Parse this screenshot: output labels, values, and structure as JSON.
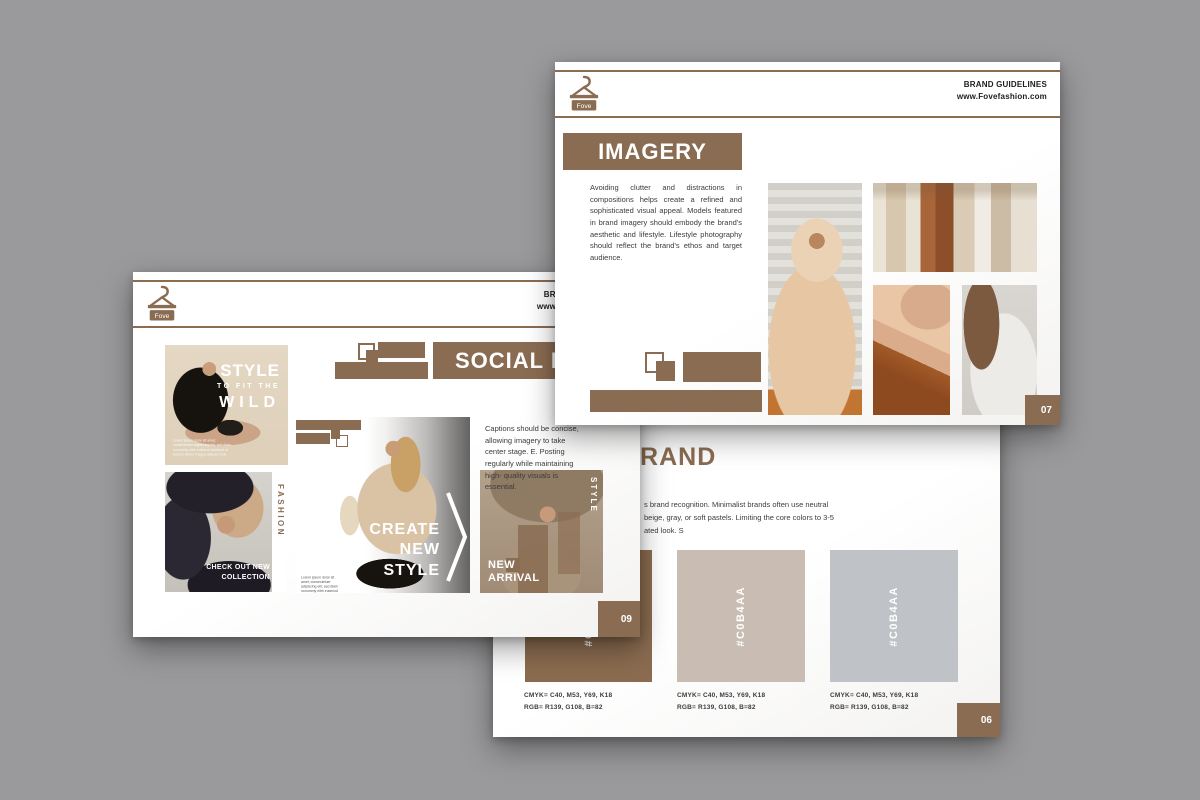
{
  "background": "#9a9a9c",
  "theme": {
    "brown": "#8a6c52",
    "text_dark": "#3c3c3c"
  },
  "logo": {
    "name": "Fove"
  },
  "header": {
    "line1": "BRAND GUIDELINES",
    "line2": "www.Fovefashion.com"
  },
  "pages": {
    "imagery": {
      "title": "IMAGERY",
      "body": "Avoiding clutter and distractions in compositions helps create a refined and sophisticated visual appeal. Models featured in brand imagery should embody the brand's aesthetic and lifestyle. Lifestyle photography should reflect the brand's ethos and target audience.",
      "page_number": "07"
    },
    "social": {
      "title": "SOCIAL MEDIA",
      "caption": "Captions should be concise, allowing imagery to take center stage. E. Posting regularly while maintaining high- quality visuals is essential.",
      "page_number": "09",
      "posts": {
        "wild": {
          "line1": "STYLE",
          "line2": "TO FIT THE",
          "line3": "WILD"
        },
        "fashion": {
          "vertical": "FASHION",
          "cta1": "CHECK OUT NEW",
          "cta2": "COLLECTION"
        },
        "create": {
          "line1": "CREATE",
          "line2": "NEW",
          "line3": "STYLE"
        },
        "arrival": {
          "vertical": "STYLE",
          "label1": "NEW",
          "label2": "ARRIVAL"
        }
      },
      "fine_print": "Lorem ipsum dolor sit amet, consectetuer adipiscing elit, sed diam nonummy nibh euismod tincidunt ut laoreet dolore magna aliquam erat."
    },
    "brand": {
      "title": "BRAND",
      "body_line1": "s brand recognition. Minimalist brands often use neutral",
      "body_line2": "beige, gray, or soft pastels. Limiting the core colors to 3-5",
      "body_line3": "ated look. S",
      "page_number": "06",
      "swatches": [
        {
          "hex": "#C0B4AA",
          "fill": "#8b6c50",
          "cmyk": "CMYK= C40, M53, Y69, K18",
          "rgb": "RGB= R139, G108, B=82"
        },
        {
          "hex": "#C0B4AA",
          "fill": "#c9bdb3",
          "cmyk": "CMYK= C40, M53, Y69, K18",
          "rgb": "RGB= R139, G108, B=82"
        },
        {
          "hex": "#C0B4AA",
          "fill": "#bfc2c6",
          "cmyk": "CMYK= C40, M53, Y69, K18",
          "rgb": "RGB= R139, G108, B=82"
        }
      ]
    }
  }
}
